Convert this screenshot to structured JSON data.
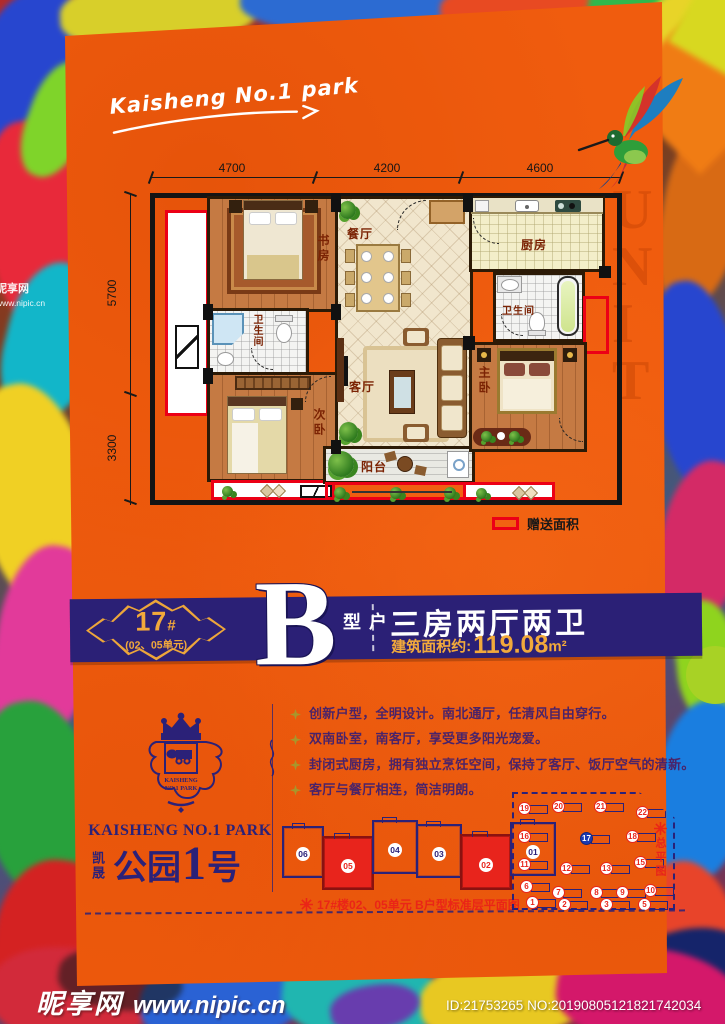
{
  "colors": {
    "poster_orange": "#f05c0e",
    "banner_navy": "#2b2076",
    "brand_navy": "#2b2178",
    "gold": "#f2a93b",
    "gift_red": "#ec0016",
    "caption_red": "#ea2517"
  },
  "poster": {
    "handwritten_title": "Kaisheng No.1 park",
    "ghost_text": "UNIT"
  },
  "floor_plan": {
    "dim_top": [
      "4700",
      "4200",
      "4600"
    ],
    "dim_left": [
      "5700",
      "3300"
    ],
    "rooms": {
      "study": "书房",
      "dining": "餐厅",
      "kitchen": "厨房",
      "bath_left": "卫生间",
      "bath_right": "卫生间",
      "living": "客厅",
      "second_bedroom": "次卧",
      "master_bedroom": "主卧",
      "balcony": "阳台"
    },
    "legend": "赠送面积"
  },
  "banner": {
    "block_no": "17",
    "block_hash": "#",
    "unit_note": "(02、05单元)",
    "type_letter": "B",
    "type_label": "户型",
    "spec": "三房两厅两卫",
    "area_label": "建筑面积约:",
    "area_value": "119.08",
    "area_unit": "m²"
  },
  "brand": {
    "crest_line1": "KAISHENG",
    "crest_line2": "NO.1 PARK",
    "en_name": "KAISHENG NO.1 PARK",
    "cn_prefix": "凯晟",
    "cn_word": "公园",
    "cn_number": "1",
    "cn_suffix": "号"
  },
  "features": [
    "创新户型，全明设计。南北通厅，任清风自由穿行。",
    "双南卧室，南客厅，享受更多阳光宠爱。",
    "封闭式厨房，拥有独立烹饪空间，保持了客厅、饭厅空气的清新。",
    "客厅与餐厅相连，简洁明朗。"
  ],
  "floor_plate": {
    "caption": "17#楼02、05单元 B户型标准层平面图",
    "units": [
      {
        "num": "06",
        "x": 0,
        "y": 12,
        "w": 42,
        "h": 52,
        "hl": false
      },
      {
        "num": "05",
        "x": 40,
        "y": 22,
        "w": 52,
        "h": 54,
        "hl": true
      },
      {
        "num": "04",
        "x": 90,
        "y": 6,
        "w": 46,
        "h": 54,
        "hl": false
      },
      {
        "num": "03",
        "x": 134,
        "y": 10,
        "w": 46,
        "h": 54,
        "hl": false
      },
      {
        "num": "02",
        "x": 178,
        "y": 20,
        "w": 52,
        "h": 56,
        "hl": true
      },
      {
        "num": "01",
        "x": 228,
        "y": 8,
        "w": 46,
        "h": 54,
        "hl": false
      }
    ]
  },
  "site_plan": {
    "label": "总平图",
    "highlight": "17",
    "buildings": [
      {
        "num": "19",
        "x": 4,
        "y": 8
      },
      {
        "num": "20",
        "x": 38,
        "y": 6
      },
      {
        "num": "21",
        "x": 80,
        "y": 6
      },
      {
        "num": "22",
        "x": 122,
        "y": 12
      },
      {
        "num": "16",
        "x": 4,
        "y": 36
      },
      {
        "num": "17",
        "x": 66,
        "y": 38
      },
      {
        "num": "18",
        "x": 112,
        "y": 36
      },
      {
        "num": "11",
        "x": 4,
        "y": 64
      },
      {
        "num": "12",
        "x": 46,
        "y": 68
      },
      {
        "num": "13",
        "x": 86,
        "y": 68
      },
      {
        "num": "15",
        "x": 120,
        "y": 62
      },
      {
        "num": "6",
        "x": 6,
        "y": 86
      },
      {
        "num": "7",
        "x": 38,
        "y": 92
      },
      {
        "num": "8",
        "x": 76,
        "y": 92
      },
      {
        "num": "9",
        "x": 102,
        "y": 92
      },
      {
        "num": "10",
        "x": 130,
        "y": 90
      },
      {
        "num": "1",
        "x": 12,
        "y": 102
      },
      {
        "num": "2",
        "x": 44,
        "y": 104
      },
      {
        "num": "3",
        "x": 86,
        "y": 104
      },
      {
        "num": "5",
        "x": 124,
        "y": 104
      }
    ]
  },
  "watermark": {
    "site": "昵享网",
    "url": "www.nipic.cn",
    "id_line": "ID:21753265 NO:20190805121821742034",
    "side_site": "昵享网",
    "side_url": "www.nipic.cn"
  }
}
